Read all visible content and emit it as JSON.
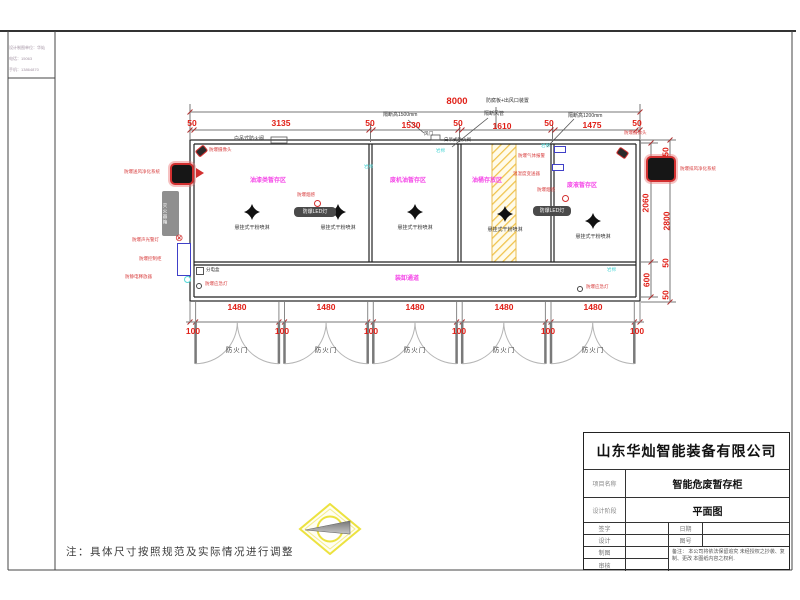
{
  "info_box": {
    "lines": [
      "设计制图单位：华灿",
      "电话：15063",
      "手机：13864870"
    ]
  },
  "dims": {
    "total": "8000",
    "top_row": [
      "50",
      "3135",
      "50",
      "1530",
      "50",
      "1610",
      "50",
      "1475",
      "50"
    ],
    "right_inner": [
      "2060",
      "600"
    ],
    "right_outer": [
      "50",
      "2800",
      "50",
      "50"
    ]
  },
  "doors": {
    "label": "防火门",
    "width": "1480",
    "pier": "100"
  },
  "rooms": {
    "r1": "油漆类暂存区",
    "r2": "废机油暂存区",
    "r3": "油桶存放区",
    "r4": "废液暂存区",
    "walkway": "装卸通道"
  },
  "annotations": {
    "cam_left": "防爆摄像头",
    "cam_right": "防爆摄像头",
    "fan_left": "防爆送风净化系统",
    "fan_right": "防爆排风净化系统",
    "damper1": "白吊式防火阀",
    "damper2": "白吊式防火阀",
    "vent": "风门",
    "partition1500": "隔断高1500mm",
    "partition_duct": "隔断风管",
    "partition1200": "隔断高1200mm",
    "roof": "防腐板+出风口装置",
    "ext_box": "灭火器箱",
    "alarm_light": "防爆声光警灯",
    "control_cab": "防爆控制柜",
    "static_release": "防静电释放器",
    "junction_box": "分电盒",
    "emergency": "防爆应急灯",
    "smoke": "防爆烟感",
    "led": "防爆LED灯",
    "gas_alarm": "防爆气体报警",
    "humidity": "温湿度变送器",
    "sprinkler": "悬挂式干粉喷淋",
    "insulation": "岩棉"
  },
  "note": "注：具体尺寸按照规范及实际情况进行调整",
  "title_block": {
    "company": "山东华灿智能装备有限公司",
    "rows": [
      {
        "label": "项目名称",
        "value": "智能危废暂存柜"
      },
      {
        "label": "设计阶段",
        "value": "平面图"
      }
    ],
    "sign_rows": [
      "签字",
      "设计",
      "制图",
      "审核"
    ],
    "right_rows": [
      "日期",
      "图号"
    ],
    "remark": "备注： 本公司将依法保留追究 未经授权之抄袭、复制、更改 本图纸内容之权利."
  }
}
